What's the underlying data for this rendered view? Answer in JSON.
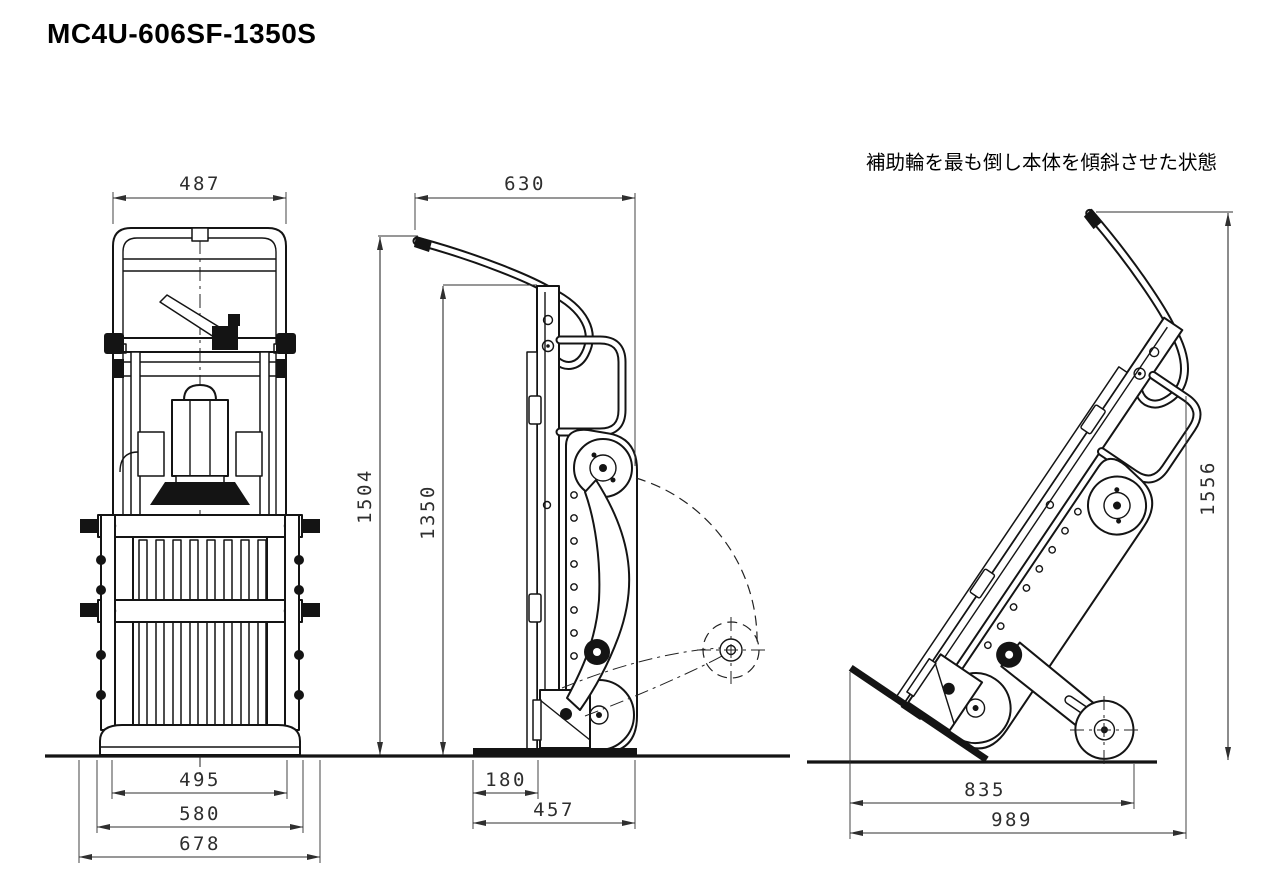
{
  "title": "MC4U-606SF-1350S",
  "annotation": "補助輪を最も倒し本体を傾斜させた状態",
  "colors": {
    "line": "#141414",
    "dim": "#2f2f2f",
    "background": "#ffffff"
  },
  "views": {
    "front": {
      "name": "front view",
      "dims": {
        "handle_width": "487",
        "base_inner_width": "495",
        "base_mid_width": "580",
        "overall_width": "678"
      }
    },
    "side": {
      "name": "side view",
      "dims": {
        "top_depth": "630",
        "overall_height": "1504",
        "body_height": "1350",
        "toe_depth": "180",
        "base_depth": "457"
      }
    },
    "tilted": {
      "name": "tilted view (auxiliary wheel fully lowered, body inclined)",
      "dims": {
        "tilted_height": "1556",
        "wheel_span": "835",
        "overall_depth": "989"
      }
    }
  }
}
